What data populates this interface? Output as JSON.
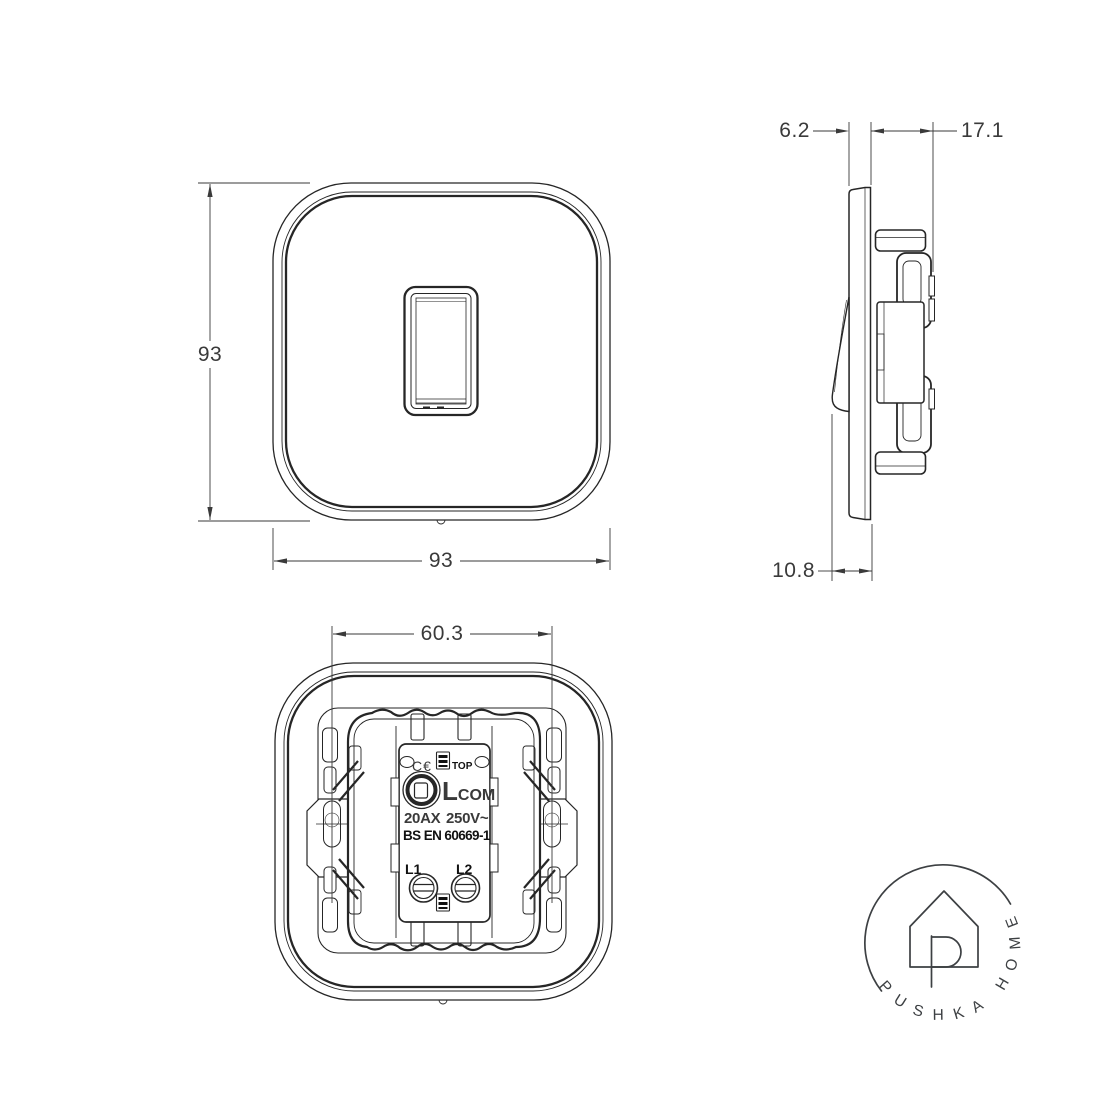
{
  "drawing": {
    "dimensions": {
      "front_height": "93",
      "front_width": "93",
      "side_plate_thickness": "6.2",
      "side_depth": "17.1",
      "side_switch_protrusion": "10.8",
      "back_fixing_centres": "60.3"
    },
    "back_markings": {
      "ce_mark": "C€",
      "top_label": "TOP",
      "l_label": "L",
      "com_label": "COM",
      "rating_current": "20AX",
      "rating_voltage": "250V~",
      "standard": "BS EN 60669-1",
      "terminal_1": "L1",
      "terminal_2": "L2"
    },
    "logo": {
      "brand_text": "PUSHKA HOME"
    },
    "colors": {
      "line": "#262626",
      "dim": "#3a3a3a",
      "logo": "#3d4043",
      "background": "#ffffff"
    }
  }
}
